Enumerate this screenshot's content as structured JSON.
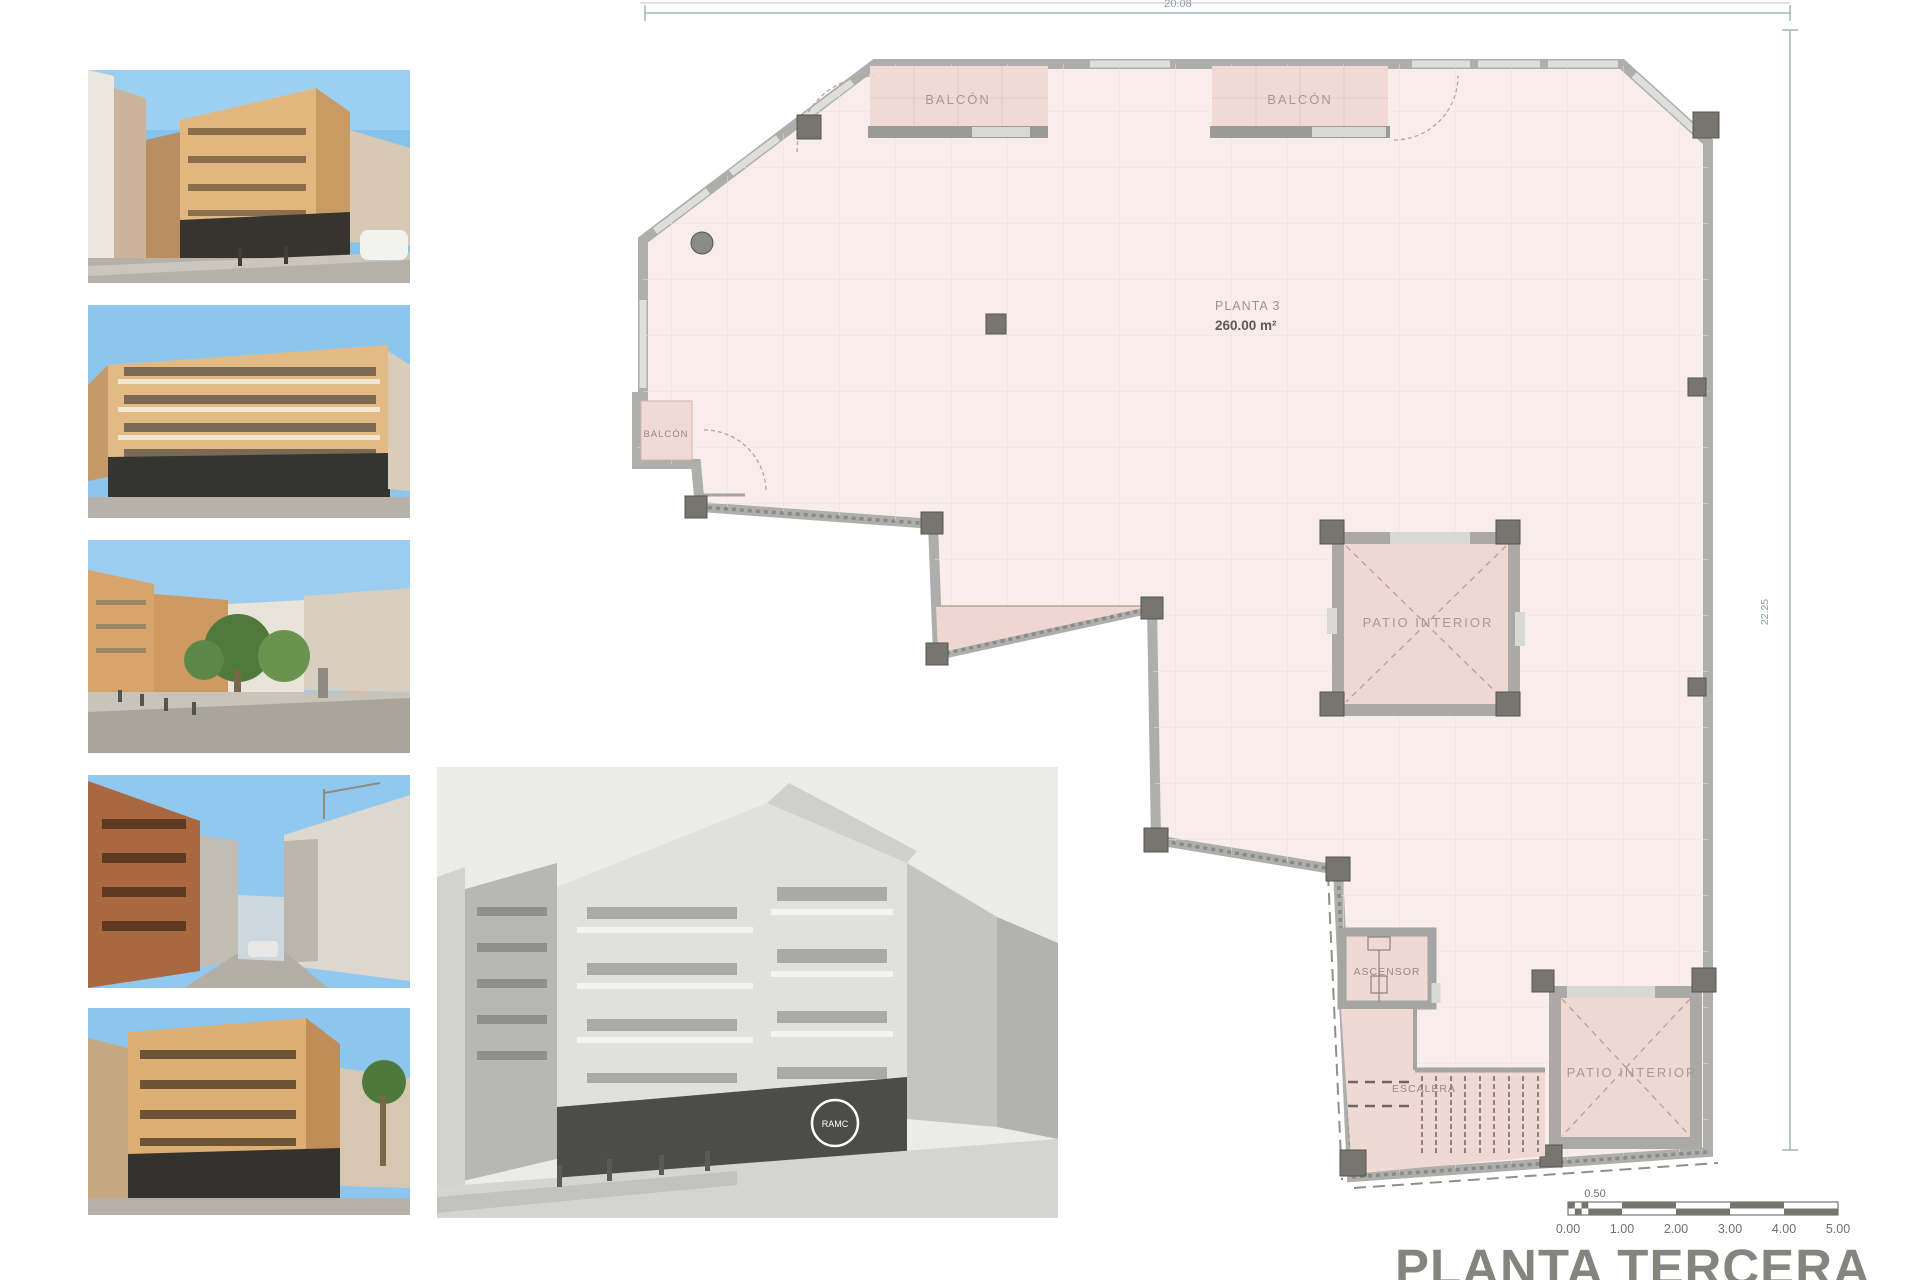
{
  "sheet": {
    "title": "PLANTA TERCERA",
    "dimensions": {
      "top": "20.08",
      "right": "22.25"
    }
  },
  "plan": {
    "labels": {
      "balcony_top_left": "BALCÓN",
      "balcony_top_right": "BALCÓN",
      "balcony_left": "BALCÓN",
      "floor_name": "PLANTA 3",
      "floor_area": "260.00 m²",
      "patio_mid": "PATIO INTERIOR",
      "patio_bottom": "PATIO INTERIOR",
      "elevator": "ASCENSOR",
      "stairs": "ESCALERA"
    },
    "colors": {
      "floor": "#f8edeb",
      "balcony": "#f1d9d4",
      "wall": "#aeaeac",
      "column": "#76766f",
      "dimension_line": "#9fb6b8",
      "title_text": "#85857f"
    }
  },
  "scalebar": {
    "half_tick": "0.50",
    "ticks": [
      "0.00",
      "1.00",
      "2.00",
      "3.00",
      "4.00",
      "5.00"
    ]
  },
  "photos": {
    "storefront_logo": "RAMC"
  }
}
